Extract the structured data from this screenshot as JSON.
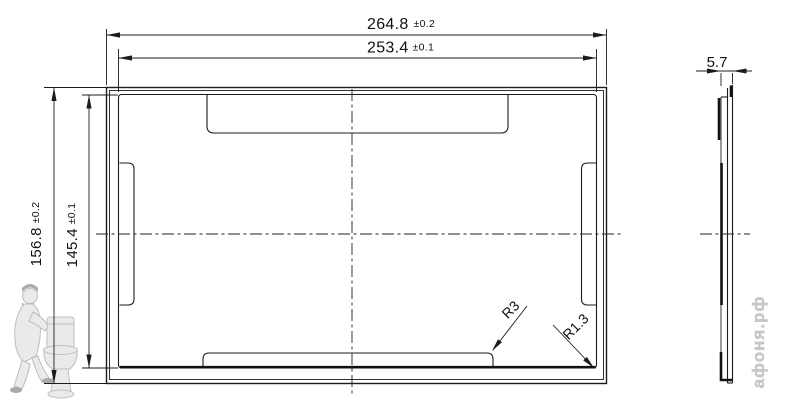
{
  "dimensions": {
    "outer_width": {
      "value": "264.8",
      "tolerance": "±0.2"
    },
    "inner_width": {
      "value": "253.4",
      "tolerance": "±0.1"
    },
    "outer_height": {
      "value": "156.8",
      "tolerance": "±0.2"
    },
    "inner_height": {
      "value": "145.4",
      "tolerance": "±0.1"
    },
    "thickness": {
      "value": "5.7"
    },
    "tab_corner_radius": {
      "label": "R3"
    },
    "frame_corner_radius": {
      "label": "R1.3"
    }
  },
  "watermark": {
    "site": "афоня.рф"
  },
  "colors": {
    "line": "#1c1c1c",
    "background": "#ffffff",
    "watermark_gray": "#c9c9c9"
  }
}
